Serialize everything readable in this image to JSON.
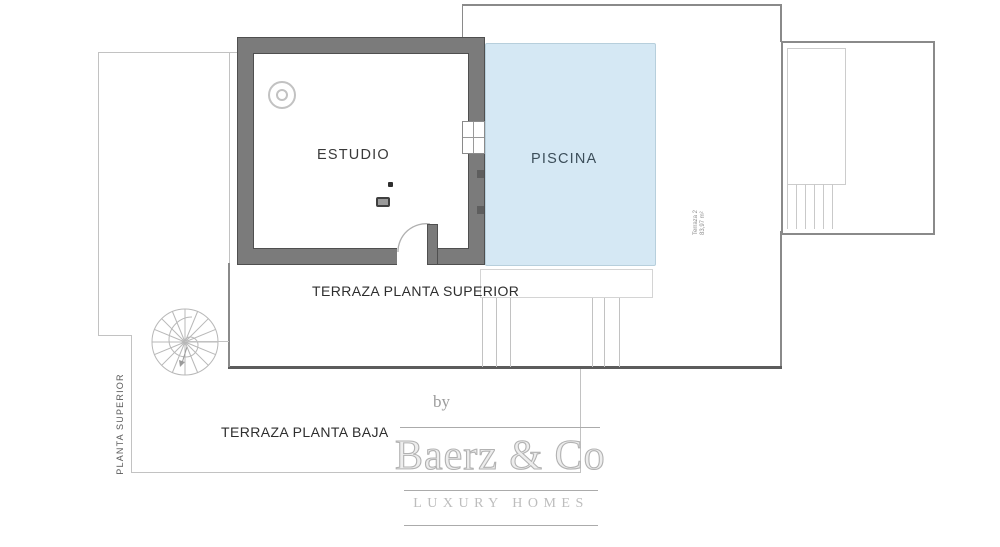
{
  "plan": {
    "rooms": {
      "estudio_label": "ESTUDIO",
      "piscina_label": "PISCINA"
    },
    "areas": {
      "terraza_superior_label": "TERRAZA PLANTA SUPERIOR",
      "terraza_baja_label": "TERRAZA PLANTA BAJA",
      "planta_superior_label": "PLANTA SUPERIOR"
    },
    "annex_note": {
      "line1": "Terraza 2",
      "line2": "83,97 m²"
    },
    "colors": {
      "pool_fill": "#d5e8f4",
      "pool_border": "#b7cfdc",
      "wall_gray": "#7b7b7b",
      "wall_edge": "#4f4f4f",
      "boundary_dark": "#5c5c5c",
      "boundary_medium": "#8a8a8a",
      "line_light": "#c2c2c2",
      "label_text": "#2e2e2e"
    }
  },
  "watermark": {
    "by_label": "by",
    "brand_name": "Baerz & Co",
    "tagline": "LUXURY HOMES"
  }
}
